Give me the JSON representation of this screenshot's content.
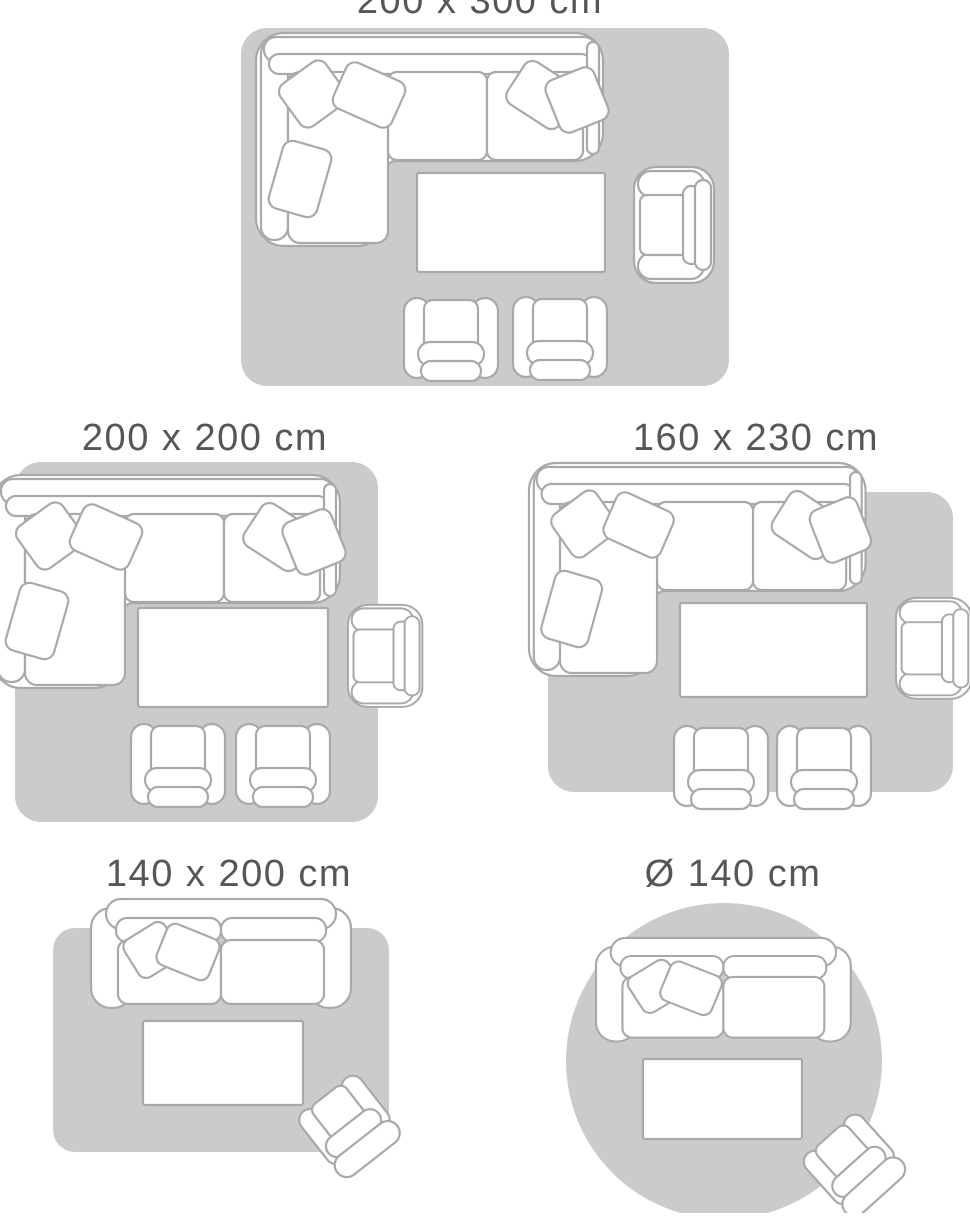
{
  "title": "Rug size guide",
  "colors": {
    "background": "#ffffff",
    "rug_fill": "#cbcbcb",
    "furniture_outline": "#a8a9ab",
    "furniture_fill": "#ffffff",
    "label_text": "#56565a"
  },
  "sections": [
    {
      "id": "size-200x300",
      "label": "200 x 300 cm",
      "rug_shape": "rectangle",
      "furniture": [
        "corner-sofa",
        "coffee-table",
        "armchair",
        "chair",
        "chair"
      ]
    },
    {
      "id": "size-200x200",
      "label": "200 x 200 cm",
      "rug_shape": "rectangle",
      "furniture": [
        "corner-sofa",
        "coffee-table",
        "armchair",
        "chair",
        "chair"
      ]
    },
    {
      "id": "size-160x230",
      "label": "160 x 230 cm",
      "rug_shape": "rectangle",
      "furniture": [
        "corner-sofa",
        "coffee-table",
        "armchair",
        "chair",
        "chair"
      ]
    },
    {
      "id": "size-140x200",
      "label": "140 x 200 cm",
      "rug_shape": "rectangle",
      "furniture": [
        "loveseat-sofa",
        "coffee-table",
        "angled-armchair"
      ]
    },
    {
      "id": "size-140-round",
      "label": "Ø 140 cm",
      "rug_shape": "circle",
      "furniture": [
        "loveseat-sofa",
        "coffee-table",
        "angled-armchair"
      ]
    }
  ]
}
